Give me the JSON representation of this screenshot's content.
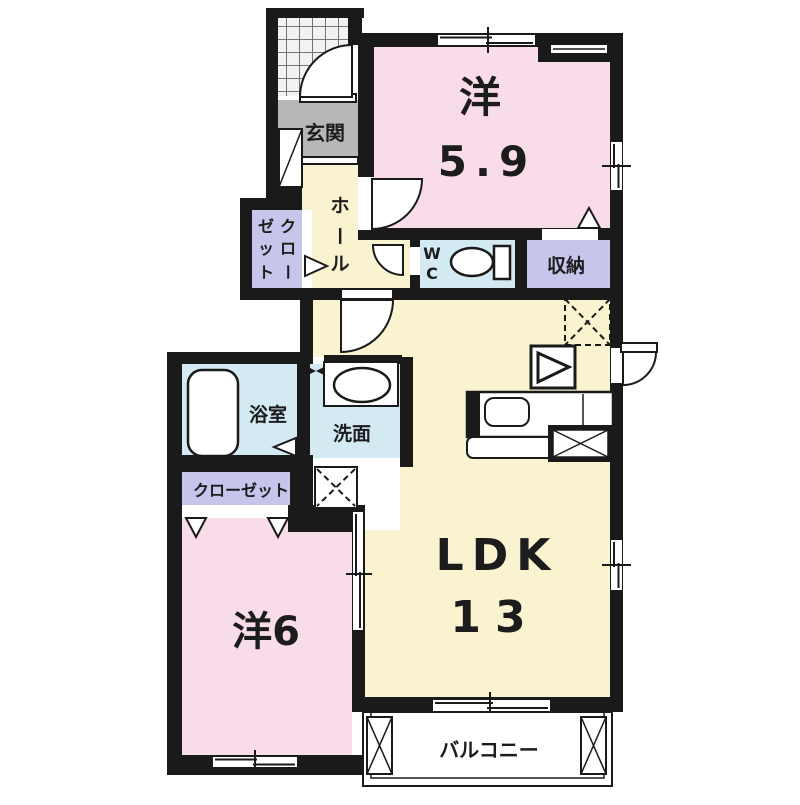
{
  "plan": {
    "type": "apartment-floor-plan",
    "colors": {
      "wall": "#1a1a1a",
      "pink_room": "#f8dcea",
      "yellow_room": "#faf3cf",
      "blue_room": "#d3eaf3",
      "purple_room": "#c8c5ec",
      "gray_entrance": "#b7b7b7",
      "white": "#ffffff"
    },
    "labels": {
      "entrance": "玄関",
      "hall_chars": [
        "ホ",
        "ー",
        "ル"
      ],
      "closet_vertical_chars": [
        "ク",
        "ロ",
        "ー",
        "ゼ",
        "ッ",
        "ト"
      ],
      "western59_kanji": "洋",
      "western59_size": "5.9",
      "wc_chars": [
        "W",
        "C"
      ],
      "storage": "収納",
      "bathroom": "浴室",
      "washroom": "洗面",
      "closet_horizontal": "クローゼット",
      "western6": "洋6",
      "ldk": "LDK",
      "ldk_size": "13",
      "balcony": "バルコニー"
    }
  }
}
